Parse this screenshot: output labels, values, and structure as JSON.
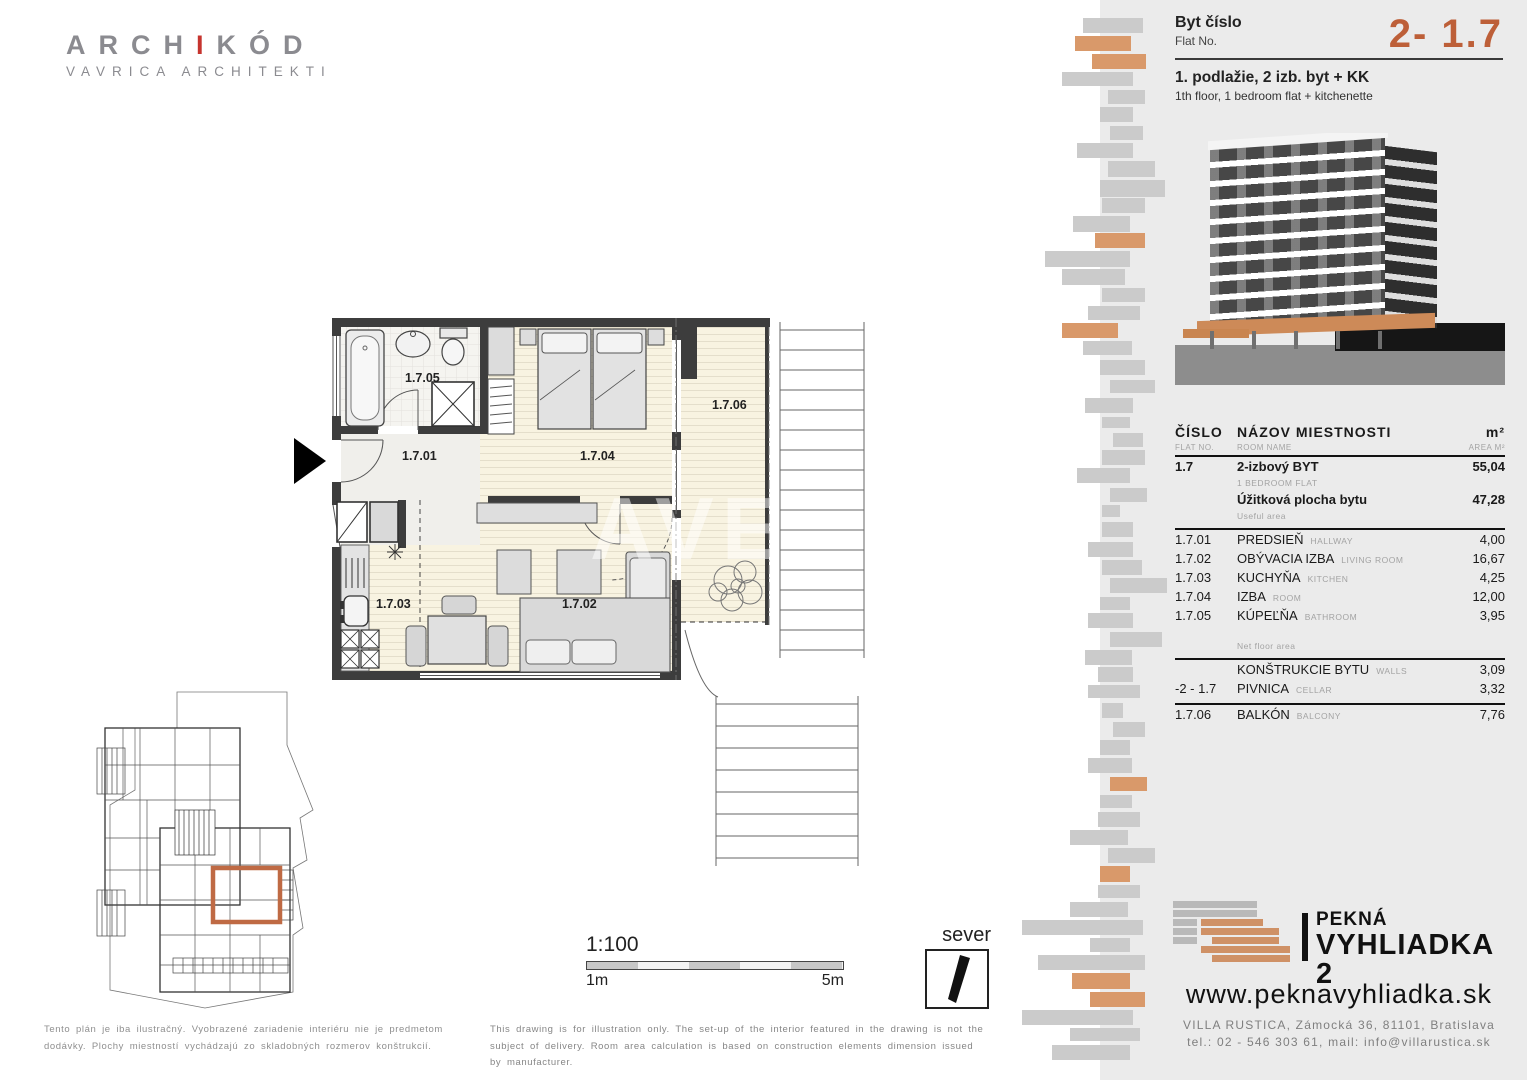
{
  "colors": {
    "accent": "#bd5f38",
    "bar_gray": "#cbcbcb",
    "bar_orange": "#d9996a",
    "panel_bg": "#ebebeb",
    "highlight": "#bf6a44"
  },
  "architect": {
    "name_pre": "ARCH",
    "name_accent": "I",
    "name_post": "KÓD",
    "subtitle": "VAVRICA ARCHITEKTI"
  },
  "flat_header": {
    "label_sk": "Byt číslo",
    "label_en": "Flat No.",
    "number": "2- 1.7",
    "floor_sk": "1. podlažie, 2 izb. byt + KK",
    "floor_en": "1th floor, 1 bedroom flat + kitchenette"
  },
  "table": {
    "header": {
      "col1_sk": "ČÍSLO",
      "col1_en": "FLAT NO.",
      "col2_sk": "NÁZOV MIESTNOSTI",
      "col2_en": "ROOM NAME",
      "col3_sk": "m²",
      "col3_en": "AREA M²"
    },
    "summary": [
      {
        "no": "1.7",
        "name_sk": "2-izbový BYT",
        "name_en": "1 BEDROOM FLAT",
        "area": "55,04"
      },
      {
        "no": "",
        "name_sk": "Úžitková plocha bytu",
        "name_en": "Useful area",
        "area": "47,28"
      }
    ],
    "rooms": [
      {
        "no": "1.7.01",
        "name_sk": "PREDSIEŇ",
        "name_en": "HALLWAY",
        "area": "4,00"
      },
      {
        "no": "1.7.02",
        "name_sk": "OBÝVACIA IZBA",
        "name_en": "LIVING ROOM",
        "area": "16,67"
      },
      {
        "no": "1.7.03",
        "name_sk": "KUCHYŇA",
        "name_en": "KITCHEN",
        "area": "4,25"
      },
      {
        "no": "1.7.04",
        "name_sk": "IZBA",
        "name_en": "ROOM",
        "area": "12,00"
      },
      {
        "no": "1.7.05",
        "name_sk": "KÚPEĽŇA",
        "name_en": "BATHROOM",
        "area": "3,95"
      }
    ],
    "net_label": "Net floor area",
    "extras": [
      {
        "no": "",
        "name_sk": "KONŠTRUKCIE BYTU",
        "name_en": "WALLS",
        "area": "3,09"
      },
      {
        "no": "-2 - 1.7",
        "name_sk": "PIVNICA",
        "name_en": "CELLAR",
        "area": "3,32"
      }
    ],
    "balcony": {
      "no": "1.7.06",
      "name_sk": "BALKÓN",
      "name_en": "BALCONY",
      "area": "7,76"
    }
  },
  "plan": {
    "labels": {
      "hallway": "1.7.01",
      "living": "1.7.02",
      "kitchen": "1.7.03",
      "bedroom": "1.7.04",
      "bathroom": "1.7.05",
      "balcony": "1.7.06"
    },
    "watermark": "AVE"
  },
  "scale": {
    "ratio": "1:100",
    "from": "1m",
    "to": "5m"
  },
  "north": {
    "label": "sever"
  },
  "disclaimer": {
    "sk": "Tento plán je iba ilustračný. Vyobrazené zariadenie interiéru nie je predmetom dodávky. Plochy miestností vychádzajú zo skladobných rozmerov konštrukcií.",
    "en": "This drawing is for illustration only. The set-up of the interior featured in the drawing is not the subject of delivery. Room area calculation is based on construction elements dimension issued by manufacturer."
  },
  "brand": {
    "line1": "PEKNÁ",
    "line2": "VYHLIADKA 2",
    "website": "www.peknavyhliadka.sk",
    "address": "VILLA RUSTICA, Zámocká 36, 81101, Bratislava",
    "contact": "tel.: 02 - 546 303 61, mail: info@villarustica.sk"
  },
  "decor": {
    "bars": [
      [
        1083,
        18,
        60,
        15,
        "g"
      ],
      [
        1075,
        36,
        56,
        15,
        "o"
      ],
      [
        1092,
        54,
        54,
        15,
        "o"
      ],
      [
        1062,
        72,
        71,
        14,
        "g"
      ],
      [
        1108,
        90,
        37,
        14,
        "g"
      ],
      [
        1100,
        107,
        33,
        15,
        "g"
      ],
      [
        1110,
        126,
        33,
        14,
        "g"
      ],
      [
        1077,
        143,
        56,
        15,
        "g"
      ],
      [
        1108,
        161,
        47,
        16,
        "g"
      ],
      [
        1100,
        180,
        65,
        17,
        "g"
      ],
      [
        1102,
        198,
        43,
        15,
        "g"
      ],
      [
        1073,
        216,
        57,
        16,
        "g"
      ],
      [
        1095,
        233,
        50,
        15,
        "o"
      ],
      [
        1045,
        251,
        85,
        16,
        "g"
      ],
      [
        1062,
        269,
        63,
        16,
        "g"
      ],
      [
        1102,
        288,
        43,
        14,
        "g"
      ],
      [
        1088,
        306,
        52,
        14,
        "g"
      ],
      [
        1062,
        323,
        56,
        15,
        "o"
      ],
      [
        1083,
        341,
        49,
        14,
        "g"
      ],
      [
        1100,
        360,
        45,
        15,
        "g"
      ],
      [
        1110,
        380,
        45,
        13,
        "g"
      ],
      [
        1085,
        398,
        48,
        15,
        "g"
      ],
      [
        1102,
        417,
        28,
        11,
        "g"
      ],
      [
        1113,
        433,
        30,
        14,
        "g"
      ],
      [
        1102,
        450,
        43,
        15,
        "g"
      ],
      [
        1077,
        468,
        53,
        15,
        "g"
      ],
      [
        1110,
        488,
        37,
        14,
        "g"
      ],
      [
        1102,
        505,
        18,
        12,
        "g"
      ],
      [
        1102,
        522,
        31,
        15,
        "g"
      ],
      [
        1088,
        542,
        45,
        15,
        "g"
      ],
      [
        1102,
        560,
        40,
        15,
        "g"
      ],
      [
        1110,
        578,
        57,
        15,
        "g"
      ],
      [
        1100,
        597,
        30,
        13,
        "g"
      ],
      [
        1088,
        613,
        45,
        15,
        "g"
      ],
      [
        1110,
        632,
        52,
        15,
        "g"
      ],
      [
        1085,
        650,
        47,
        15,
        "g"
      ],
      [
        1098,
        667,
        35,
        15,
        "g"
      ],
      [
        1088,
        685,
        52,
        13,
        "g"
      ],
      [
        1102,
        703,
        21,
        15,
        "g"
      ],
      [
        1113,
        722,
        32,
        15,
        "g"
      ],
      [
        1100,
        740,
        30,
        15,
        "g"
      ],
      [
        1088,
        758,
        44,
        15,
        "g"
      ],
      [
        1110,
        777,
        37,
        14,
        "o"
      ],
      [
        1100,
        795,
        32,
        13,
        "g"
      ],
      [
        1098,
        812,
        42,
        15,
        "g"
      ],
      [
        1070,
        830,
        58,
        15,
        "g"
      ],
      [
        1108,
        848,
        47,
        15,
        "g"
      ],
      [
        1100,
        866,
        30,
        16,
        "o"
      ],
      [
        1098,
        885,
        42,
        13,
        "g"
      ],
      [
        1070,
        902,
        58,
        15,
        "g"
      ],
      [
        1022,
        920,
        121,
        15,
        "g"
      ],
      [
        1090,
        938,
        40,
        14,
        "g"
      ],
      [
        1038,
        955,
        107,
        15,
        "g"
      ],
      [
        1072,
        973,
        58,
        16,
        "o"
      ],
      [
        1090,
        992,
        55,
        15,
        "o"
      ],
      [
        1022,
        1010,
        111,
        15,
        "g"
      ],
      [
        1070,
        1028,
        70,
        13,
        "g"
      ],
      [
        1052,
        1045,
        78,
        15,
        "g"
      ]
    ]
  }
}
